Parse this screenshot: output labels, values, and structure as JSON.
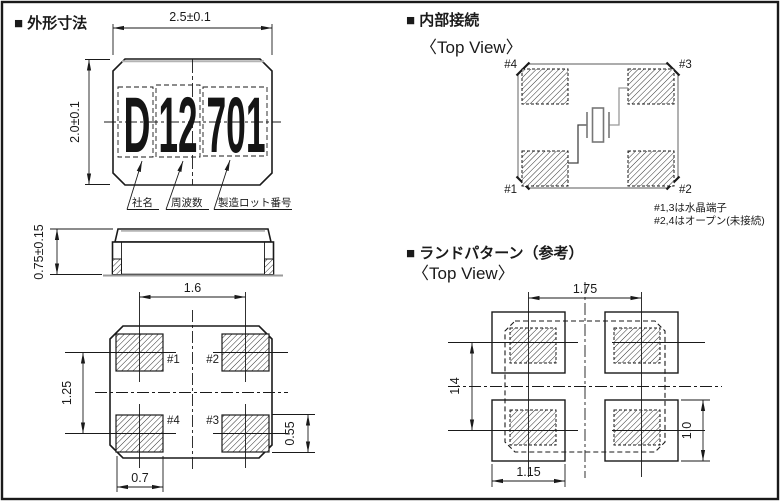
{
  "sections": {
    "outline": {
      "title": "■ 外形寸法",
      "dims": {
        "width": "2.5±0.1",
        "height": "2.0±0.1",
        "thickness": "0.75±0.15",
        "pad_pitch_x": "1.6",
        "pad_pitch_y": "1.25",
        "pad_width": "0.7",
        "pad_height": "0.55"
      },
      "marking": {
        "company": "D",
        "frequency": "12",
        "lot": "701"
      },
      "marking_labels": {
        "company": "社名",
        "frequency": "周波数",
        "lot": "製造ロット番号"
      },
      "pad_labels": {
        "p1": "#1",
        "p2": "#2",
        "p3": "#3",
        "p4": "#4"
      }
    },
    "internal": {
      "title": "■ 内部接続",
      "view": "〈Top View〉",
      "pad_labels": {
        "p1": "#1",
        "p2": "#2",
        "p3": "#3",
        "p4": "#4"
      },
      "notes": [
        "#1,3は水晶端子",
        "#2,4はオープン(未接続)"
      ]
    },
    "land": {
      "title": "■ ランドパターン（参考）",
      "view": "〈Top View〉",
      "dims": {
        "pitch_x": "1.75",
        "pitch_y": "1.4",
        "width": "1.15",
        "height": "1.0"
      }
    }
  },
  "colors": {
    "line": "#1a1a1a",
    "gray_outline": "#909090",
    "highlight": "#b0b0b0"
  }
}
